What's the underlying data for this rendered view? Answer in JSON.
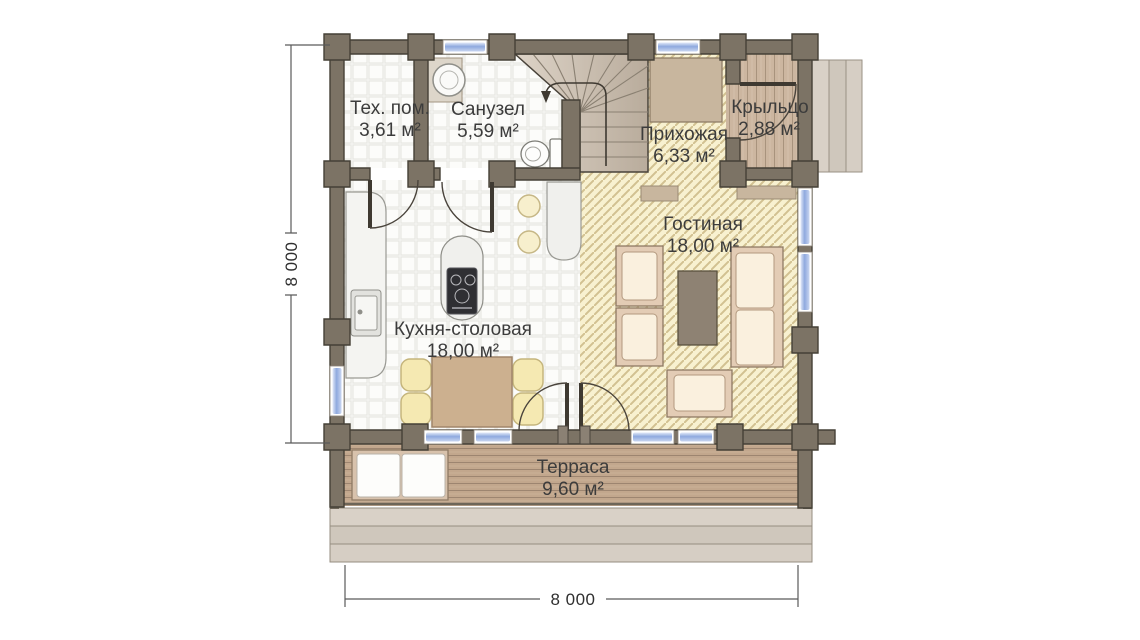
{
  "title": "Floor plan — first floor",
  "rooms": {
    "tech": {
      "name": "Тех. пом.",
      "area": "3,61 м²"
    },
    "bathroom": {
      "name": "Санузел",
      "area": "5,59 м²"
    },
    "hallway": {
      "name": "Прихожая",
      "area": "6,33 м²"
    },
    "porch": {
      "name": "Крыльцо",
      "area": "2,88 м²"
    },
    "living": {
      "name": "Гостиная",
      "area": "18,00 м²"
    },
    "kitchen": {
      "name": "Кухня-столовая",
      "area": "18,00 м²"
    },
    "terrace": {
      "name": "Терраса",
      "area": "9,60 м²"
    }
  },
  "dimensions": {
    "width": "8 000",
    "height": "8 000"
  },
  "colors": {
    "wall": "#7c7365",
    "wall_outline": "#454036",
    "tile_floor": "#f7f7f4",
    "hatch_floor": "#f8f1d0",
    "hatch_line": "#d2c191",
    "wood_porch": "#ccb6a0",
    "wood_terrace": "#c2a78d",
    "steps": "#d5cdc3",
    "glass_blue": "#8fa9de",
    "furniture_cream": "#faf0de",
    "furniture_wood": "#e3ccb5",
    "seat_yellow": "#f5e9b2",
    "table_wood": "#ccb08f",
    "coffee_table": "#8e8273",
    "text": "#3c3c3c",
    "dim": "#5a5a5a"
  }
}
